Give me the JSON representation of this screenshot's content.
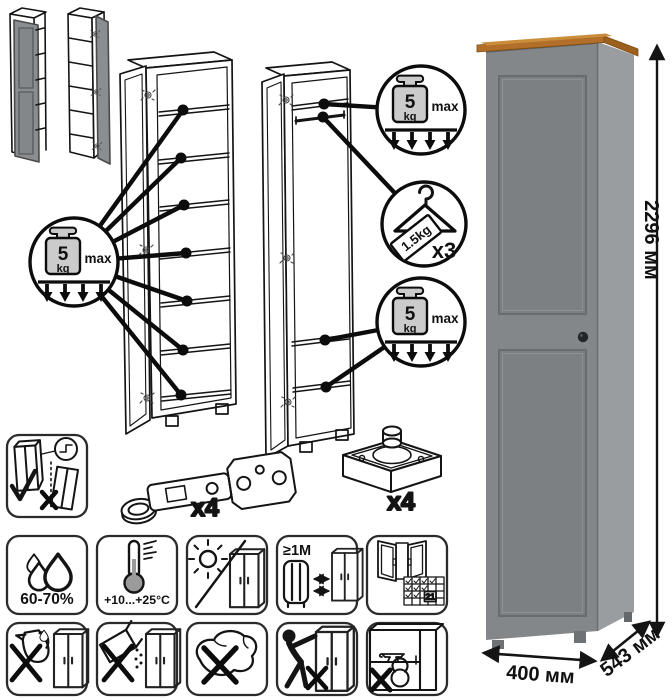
{
  "figure": {
    "load_badge": {
      "value": "5",
      "unit": "kg",
      "qualifier": "max"
    },
    "hanger_badge": {
      "weight": "1.5kg",
      "count": "x3"
    }
  },
  "hardware": {
    "hinge_count": "x4",
    "foot_count": "x4"
  },
  "care": {
    "humidity": "60-70%",
    "temperature": "+10...+25°C",
    "distance": "≥1М",
    "calendar_day": "21"
  },
  "dimensions": {
    "height": "2296 мм",
    "width": "400 мм",
    "depth": "543 мм"
  },
  "colors": {
    "front": "#848789",
    "side": "#9a9da0",
    "wood_top": "#b26f29",
    "line": "#141414"
  },
  "icons": [
    "weight-max-5kg-icon",
    "clothes-hanger-icon",
    "door-hinge-icon",
    "adjustable-foot-icon",
    "wall-anchor-warning-icon",
    "humidity-icon",
    "temperature-range-icon",
    "no-direct-sunlight-icon",
    "min-1m-from-heater-icon",
    "ventilation-21-days-icon",
    "no-spill-liquids-icon",
    "no-abrasive-powder-icon",
    "no-wet-cloth-icon",
    "no-push-drag-icon",
    "no-heavy-load-icon"
  ]
}
